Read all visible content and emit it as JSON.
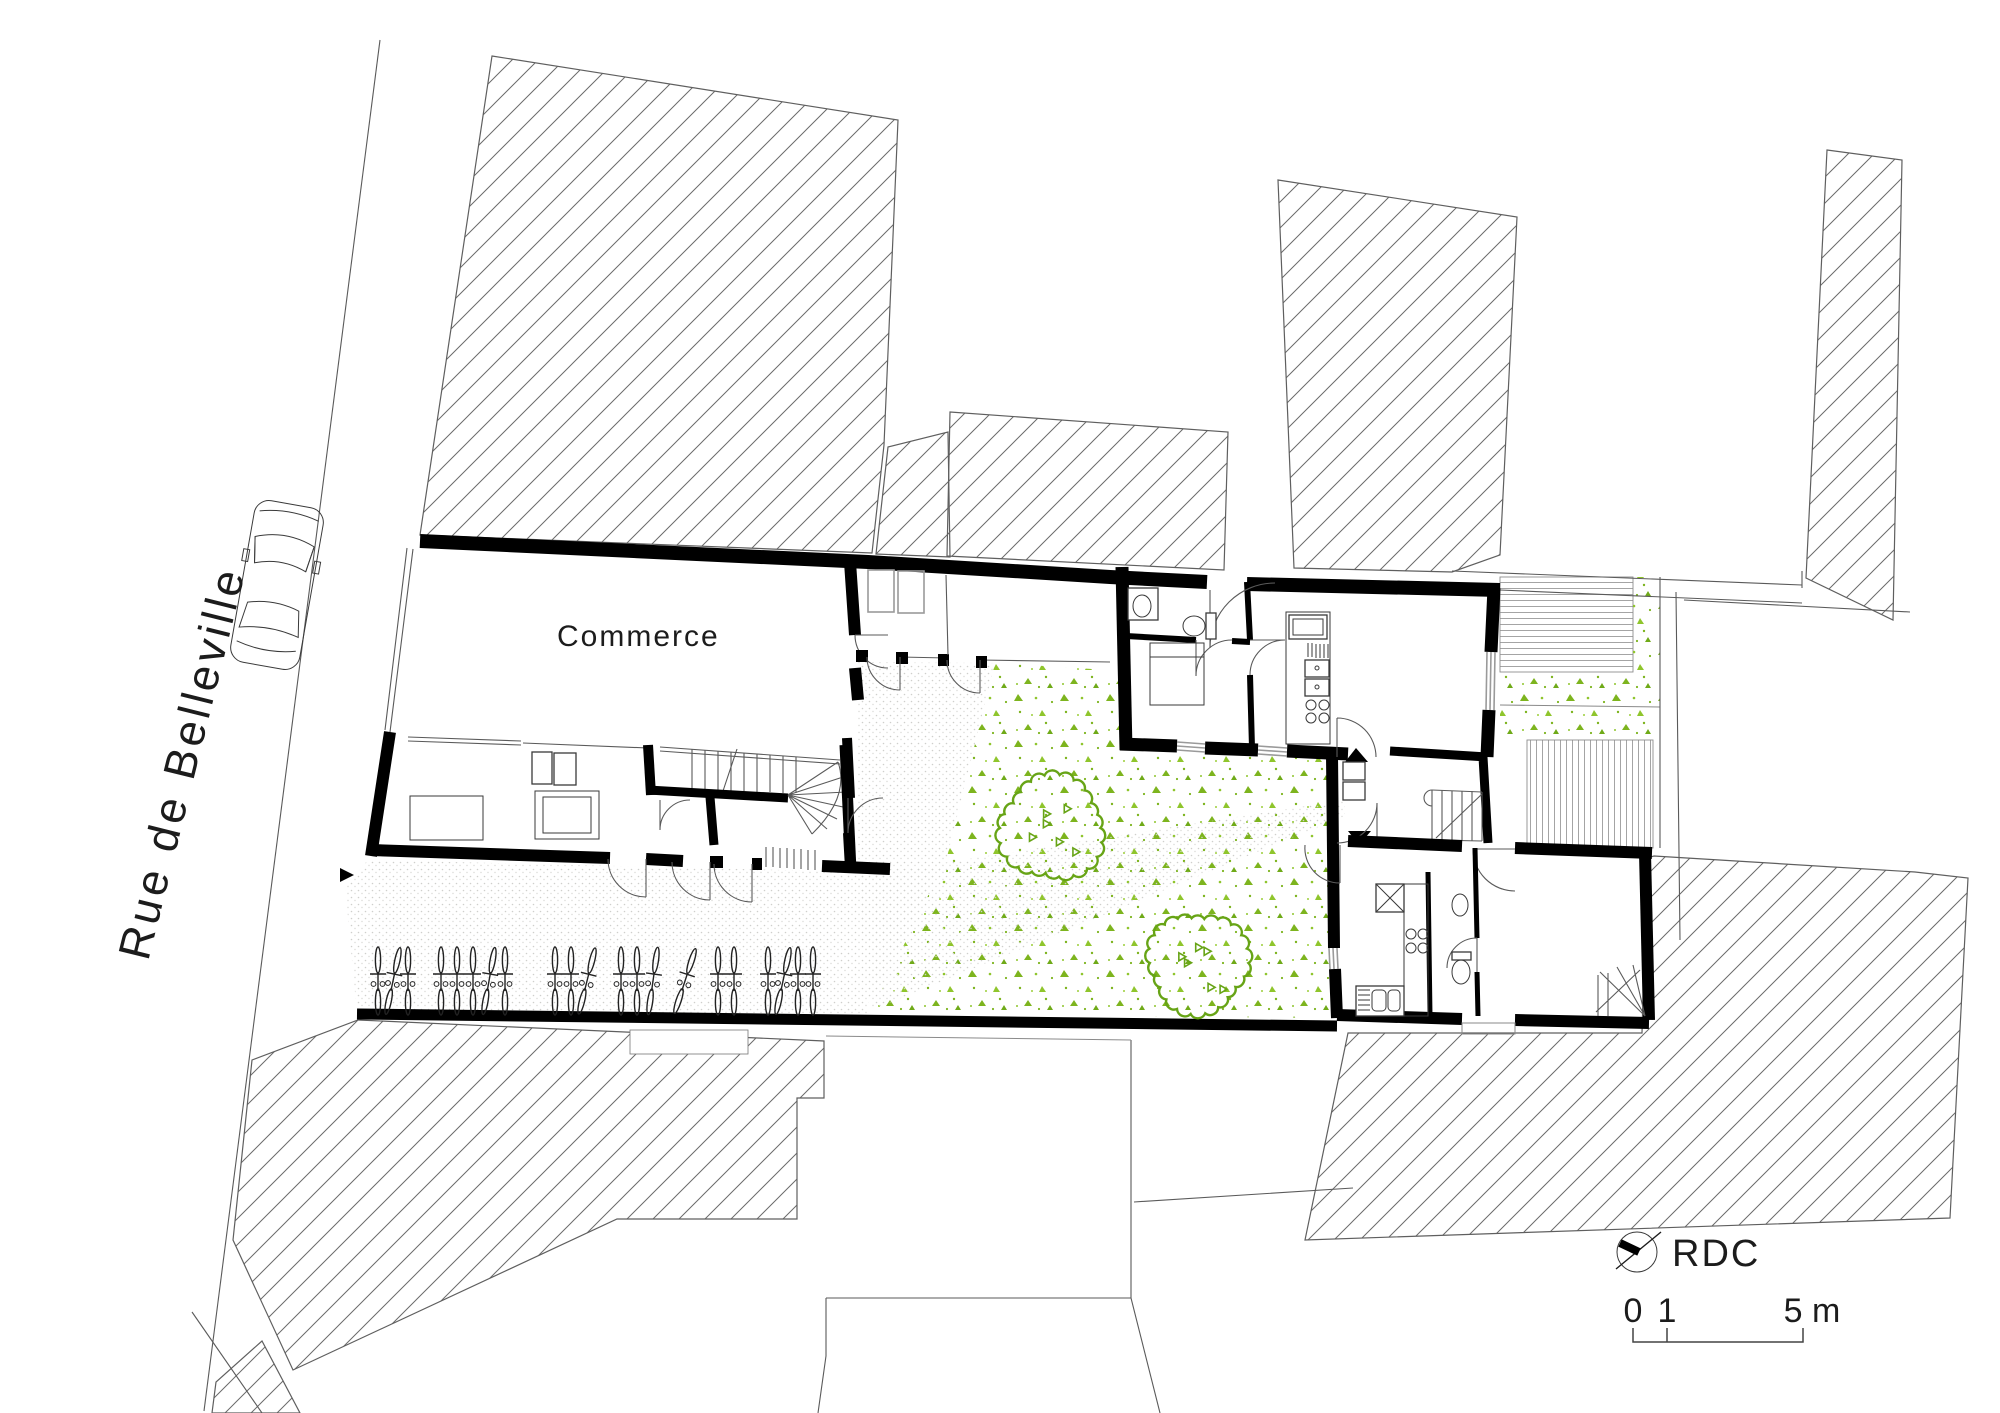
{
  "labels": {
    "street": "Rue de Belleville",
    "commerce": "Commerce",
    "level": "RDC"
  },
  "scale_bar": {
    "tick0": "0",
    "tick1": "1",
    "tick2": "5 m",
    "meters_per_unit": 1,
    "pixels_per_meter": 34
  },
  "colors": {
    "walls": "#000000",
    "hatch_lines": "#6b6b6b",
    "vegetation_green": "#7db41e",
    "tree_outline": "#67a416",
    "paving_dot": "#c9c9c6",
    "deck_line": "#9a9a9a",
    "background": "#ffffff"
  },
  "icons": [
    "north-arrow-icon",
    "car-icon",
    "bicycle-icon",
    "tree-icon",
    "entry-arrow-up-icon",
    "entry-arrow-down-icon",
    "walkway-arrow-icon"
  ],
  "bikes": {
    "count": 21,
    "center_y": 981,
    "positions": [
      {
        "x": 378,
        "tilt": 0
      },
      {
        "x": 393,
        "tilt": 12
      },
      {
        "x": 408,
        "tilt": 0
      },
      {
        "x": 441,
        "tilt": 0
      },
      {
        "x": 457,
        "tilt": 0
      },
      {
        "x": 473,
        "tilt": 0
      },
      {
        "x": 489,
        "tilt": 10
      },
      {
        "x": 505,
        "tilt": 0
      },
      {
        "x": 555,
        "tilt": 0
      },
      {
        "x": 571,
        "tilt": 0
      },
      {
        "x": 587,
        "tilt": 14
      },
      {
        "x": 621,
        "tilt": 0
      },
      {
        "x": 637,
        "tilt": 0
      },
      {
        "x": 653,
        "tilt": 8
      },
      {
        "x": 685,
        "tilt": 18
      },
      {
        "x": 718,
        "tilt": 0
      },
      {
        "x": 734,
        "tilt": 0
      },
      {
        "x": 768,
        "tilt": 0
      },
      {
        "x": 783,
        "tilt": 12
      },
      {
        "x": 798,
        "tilt": 0
      },
      {
        "x": 813,
        "tilt": 0
      }
    ]
  },
  "trees": [
    {
      "cx": 1052,
      "cy": 828,
      "r": 52
    },
    {
      "cx": 1198,
      "cy": 963,
      "r": 50
    }
  ]
}
